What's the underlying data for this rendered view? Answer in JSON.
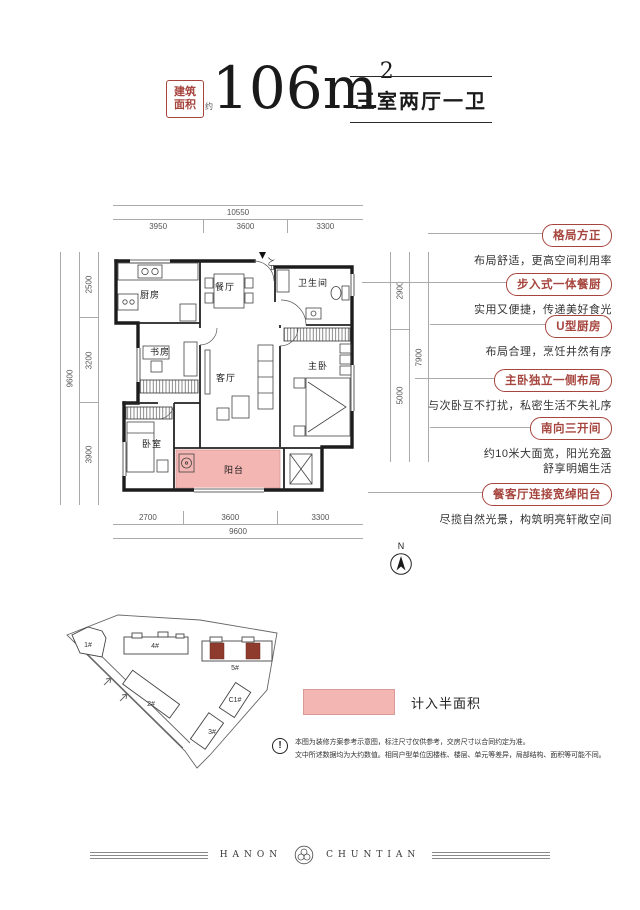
{
  "header": {
    "area_box_line1": "建筑",
    "area_box_line2": "面积",
    "area_approx": "约",
    "area_value": "106m",
    "area_sup": "2",
    "layout_text": "三室两厅一卫"
  },
  "plan": {
    "rooms": {
      "kitchen": "厨房",
      "dining": "餐厅",
      "entry": "入户",
      "bath": "卫生间",
      "study": "书房",
      "living": "客厅",
      "master": "主卧",
      "bedroom": "卧室",
      "balcony": "阳台"
    },
    "dims": {
      "top": {
        "total": "10550",
        "segments": [
          "3950",
          "3600",
          "3300"
        ]
      },
      "bottom": {
        "total": "9600",
        "segments": [
          "2700",
          "3600",
          "3300"
        ]
      },
      "left": {
        "total": "9600",
        "segments": [
          "2500",
          "3200",
          "3900"
        ]
      },
      "right": {
        "total": "7900",
        "segments": [
          "2900",
          "5000"
        ]
      }
    },
    "compass_label": "N"
  },
  "callouts": [
    {
      "title": "格局方正",
      "desc": "布局舒适，更高空间利用率"
    },
    {
      "title": "步入式一体餐厨",
      "desc": "实用又便捷，传递美好食光"
    },
    {
      "title": "U型厨房",
      "desc": "布局合理，烹饪井然有序"
    },
    {
      "title": "主卧独立一侧布局",
      "desc": "与次卧互不打扰，私密生活不失礼序"
    },
    {
      "title": "南向三开间",
      "desc": "约10米大面宽，阳光充盈",
      "desc2": "舒享明媚生活"
    },
    {
      "title": "餐客厅连接宽绰阳台",
      "desc": "尽揽自然光景，构筑明亮轩敞空间"
    }
  ],
  "siteplan": {
    "buildings": {
      "b1": "1#",
      "b2": "2#",
      "b3": "3#",
      "b4": "4#",
      "b5": "5#",
      "c1": "C1#"
    }
  },
  "legend": {
    "label": "计入半面积"
  },
  "disclaimer": {
    "line1": "本图为装修方案参考示意图，标注尺寸仅供参考，交房尺寸以合同约定为准。",
    "line2": "文中所述数据均为大约数值。相同户型单位因楼栋、楼层、单元等差异，局部结构、面积等可能不同。"
  },
  "footer": {
    "brand_left": "HANON",
    "brand_right": "CHUNTIAN"
  },
  "colors": {
    "accent_red": "#a6453d",
    "balcony_pink": "#f4b6b3",
    "unit_red": "#8e3b2d",
    "dim_gray": "#8a8a8a",
    "wall_black": "#1c1c1c"
  }
}
